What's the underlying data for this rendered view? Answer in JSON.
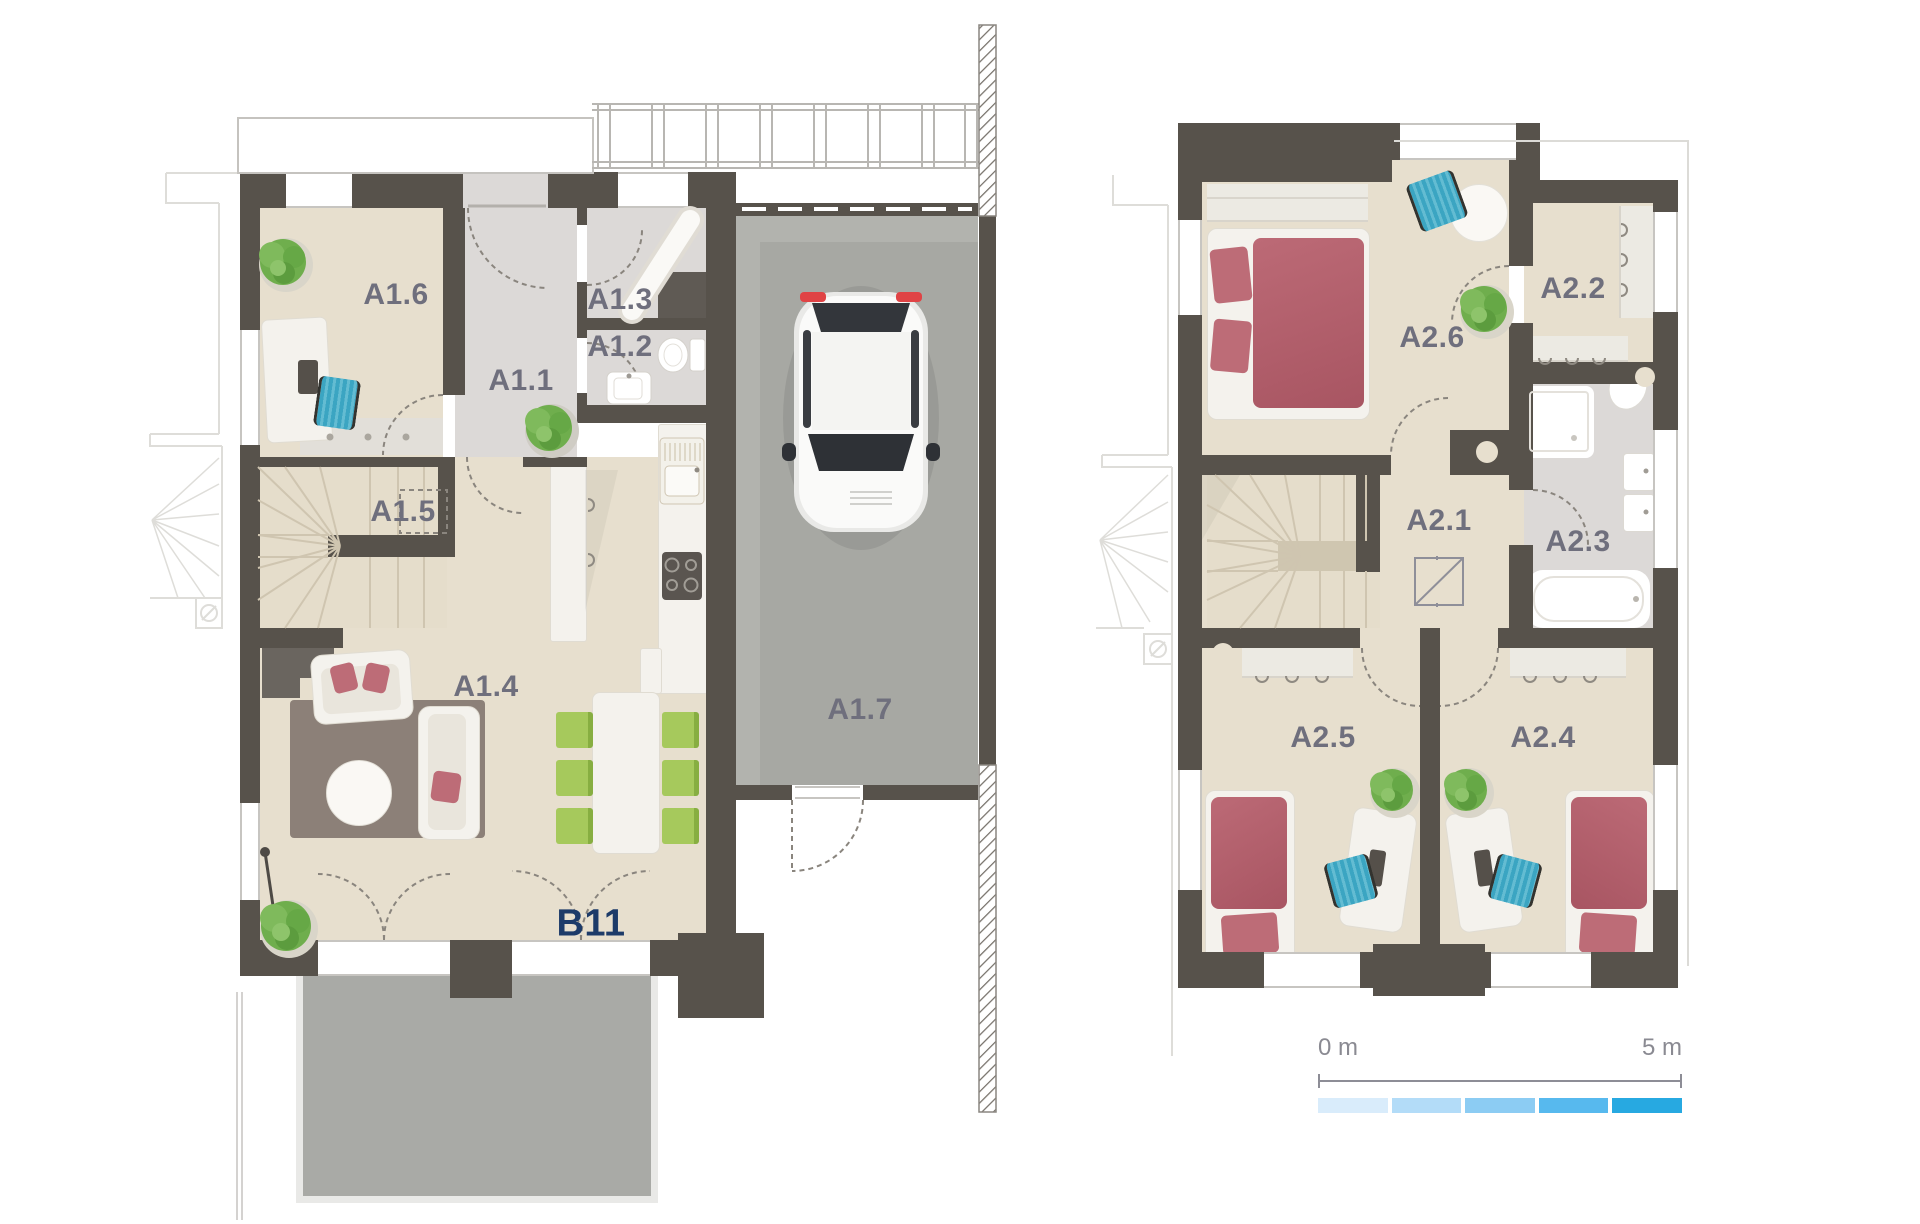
{
  "title": "Two-storey townhouse floor plans",
  "colors": {
    "wall": "#57524b",
    "floor_beige": "#e7dfce",
    "floor_gray": "#dcd9d7",
    "garage_floor": "#a7a8a3",
    "terrace": "#a9aaa6",
    "stair_tread": "#e5ddcb",
    "furniture_white": "#f4f2ed",
    "rug": "#8c8078",
    "bed_red": "#b2606b",
    "chair_green": "#a6c95c",
    "chair_teal": "#41aac4",
    "plant_green": "#6fae4d",
    "label_text": "#6f6f7d",
    "unit_label_text": "#1d3b69",
    "scale_text": "#8a8a92"
  },
  "ground_floor": {
    "unit_label": "B11",
    "rooms": [
      {
        "label": "A1.1"
      },
      {
        "label": "A1.2"
      },
      {
        "label": "A1.3"
      },
      {
        "label": "A1.4"
      },
      {
        "label": "A1.5"
      },
      {
        "label": "A1.6"
      },
      {
        "label": "A1.7"
      }
    ]
  },
  "upper_floor": {
    "rooms": [
      {
        "label": "A2.1"
      },
      {
        "label": "A2.2"
      },
      {
        "label": "A2.3"
      },
      {
        "label": "A2.4"
      },
      {
        "label": "A2.5"
      },
      {
        "label": "A2.6"
      }
    ]
  },
  "scale_bar": {
    "start_label": "0 m",
    "end_label": "5 m",
    "segment_colors": [
      "#d9ecfb",
      "#b3dcf8",
      "#8cccf3",
      "#57b9ee",
      "#27a9e1"
    ]
  }
}
